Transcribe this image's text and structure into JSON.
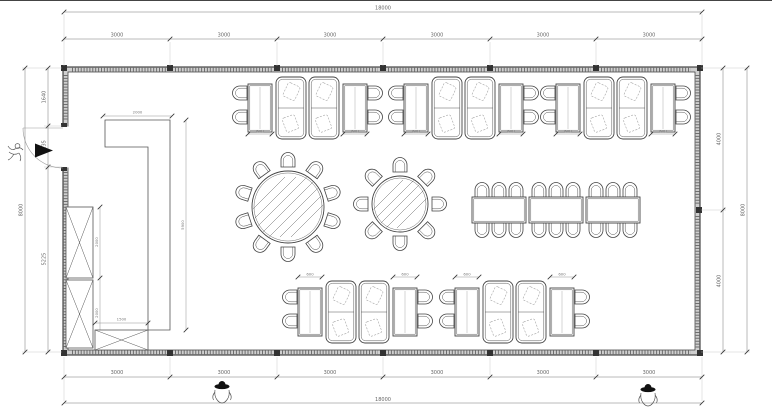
{
  "drawing": {
    "type": "floor-plan",
    "subject": "restaurant dining room furniture layout"
  },
  "dimensions": {
    "top": {
      "total": "18000",
      "segments": [
        "3000",
        "3000",
        "3000",
        "3000",
        "3000",
        "3000"
      ]
    },
    "bottom": {
      "total": "18000",
      "segments": [
        "3000",
        "3000",
        "3000",
        "3000",
        "3000",
        "3000"
      ]
    },
    "left": {
      "total": "8000",
      "segments": [
        "1640",
        "1135",
        "5225"
      ]
    },
    "right": {
      "total": "8000",
      "segments": [
        "4000",
        "4000"
      ]
    },
    "counter": {
      "width": "2000",
      "length": "5900"
    },
    "cabinets": {
      "upper": "2000",
      "lower": "2000",
      "bench": "1500"
    },
    "booth_table_width": "600"
  },
  "colors": {
    "line": "#444",
    "dim": "#777",
    "wall_fill": "#cfcfcf",
    "accent_black": "#111"
  }
}
